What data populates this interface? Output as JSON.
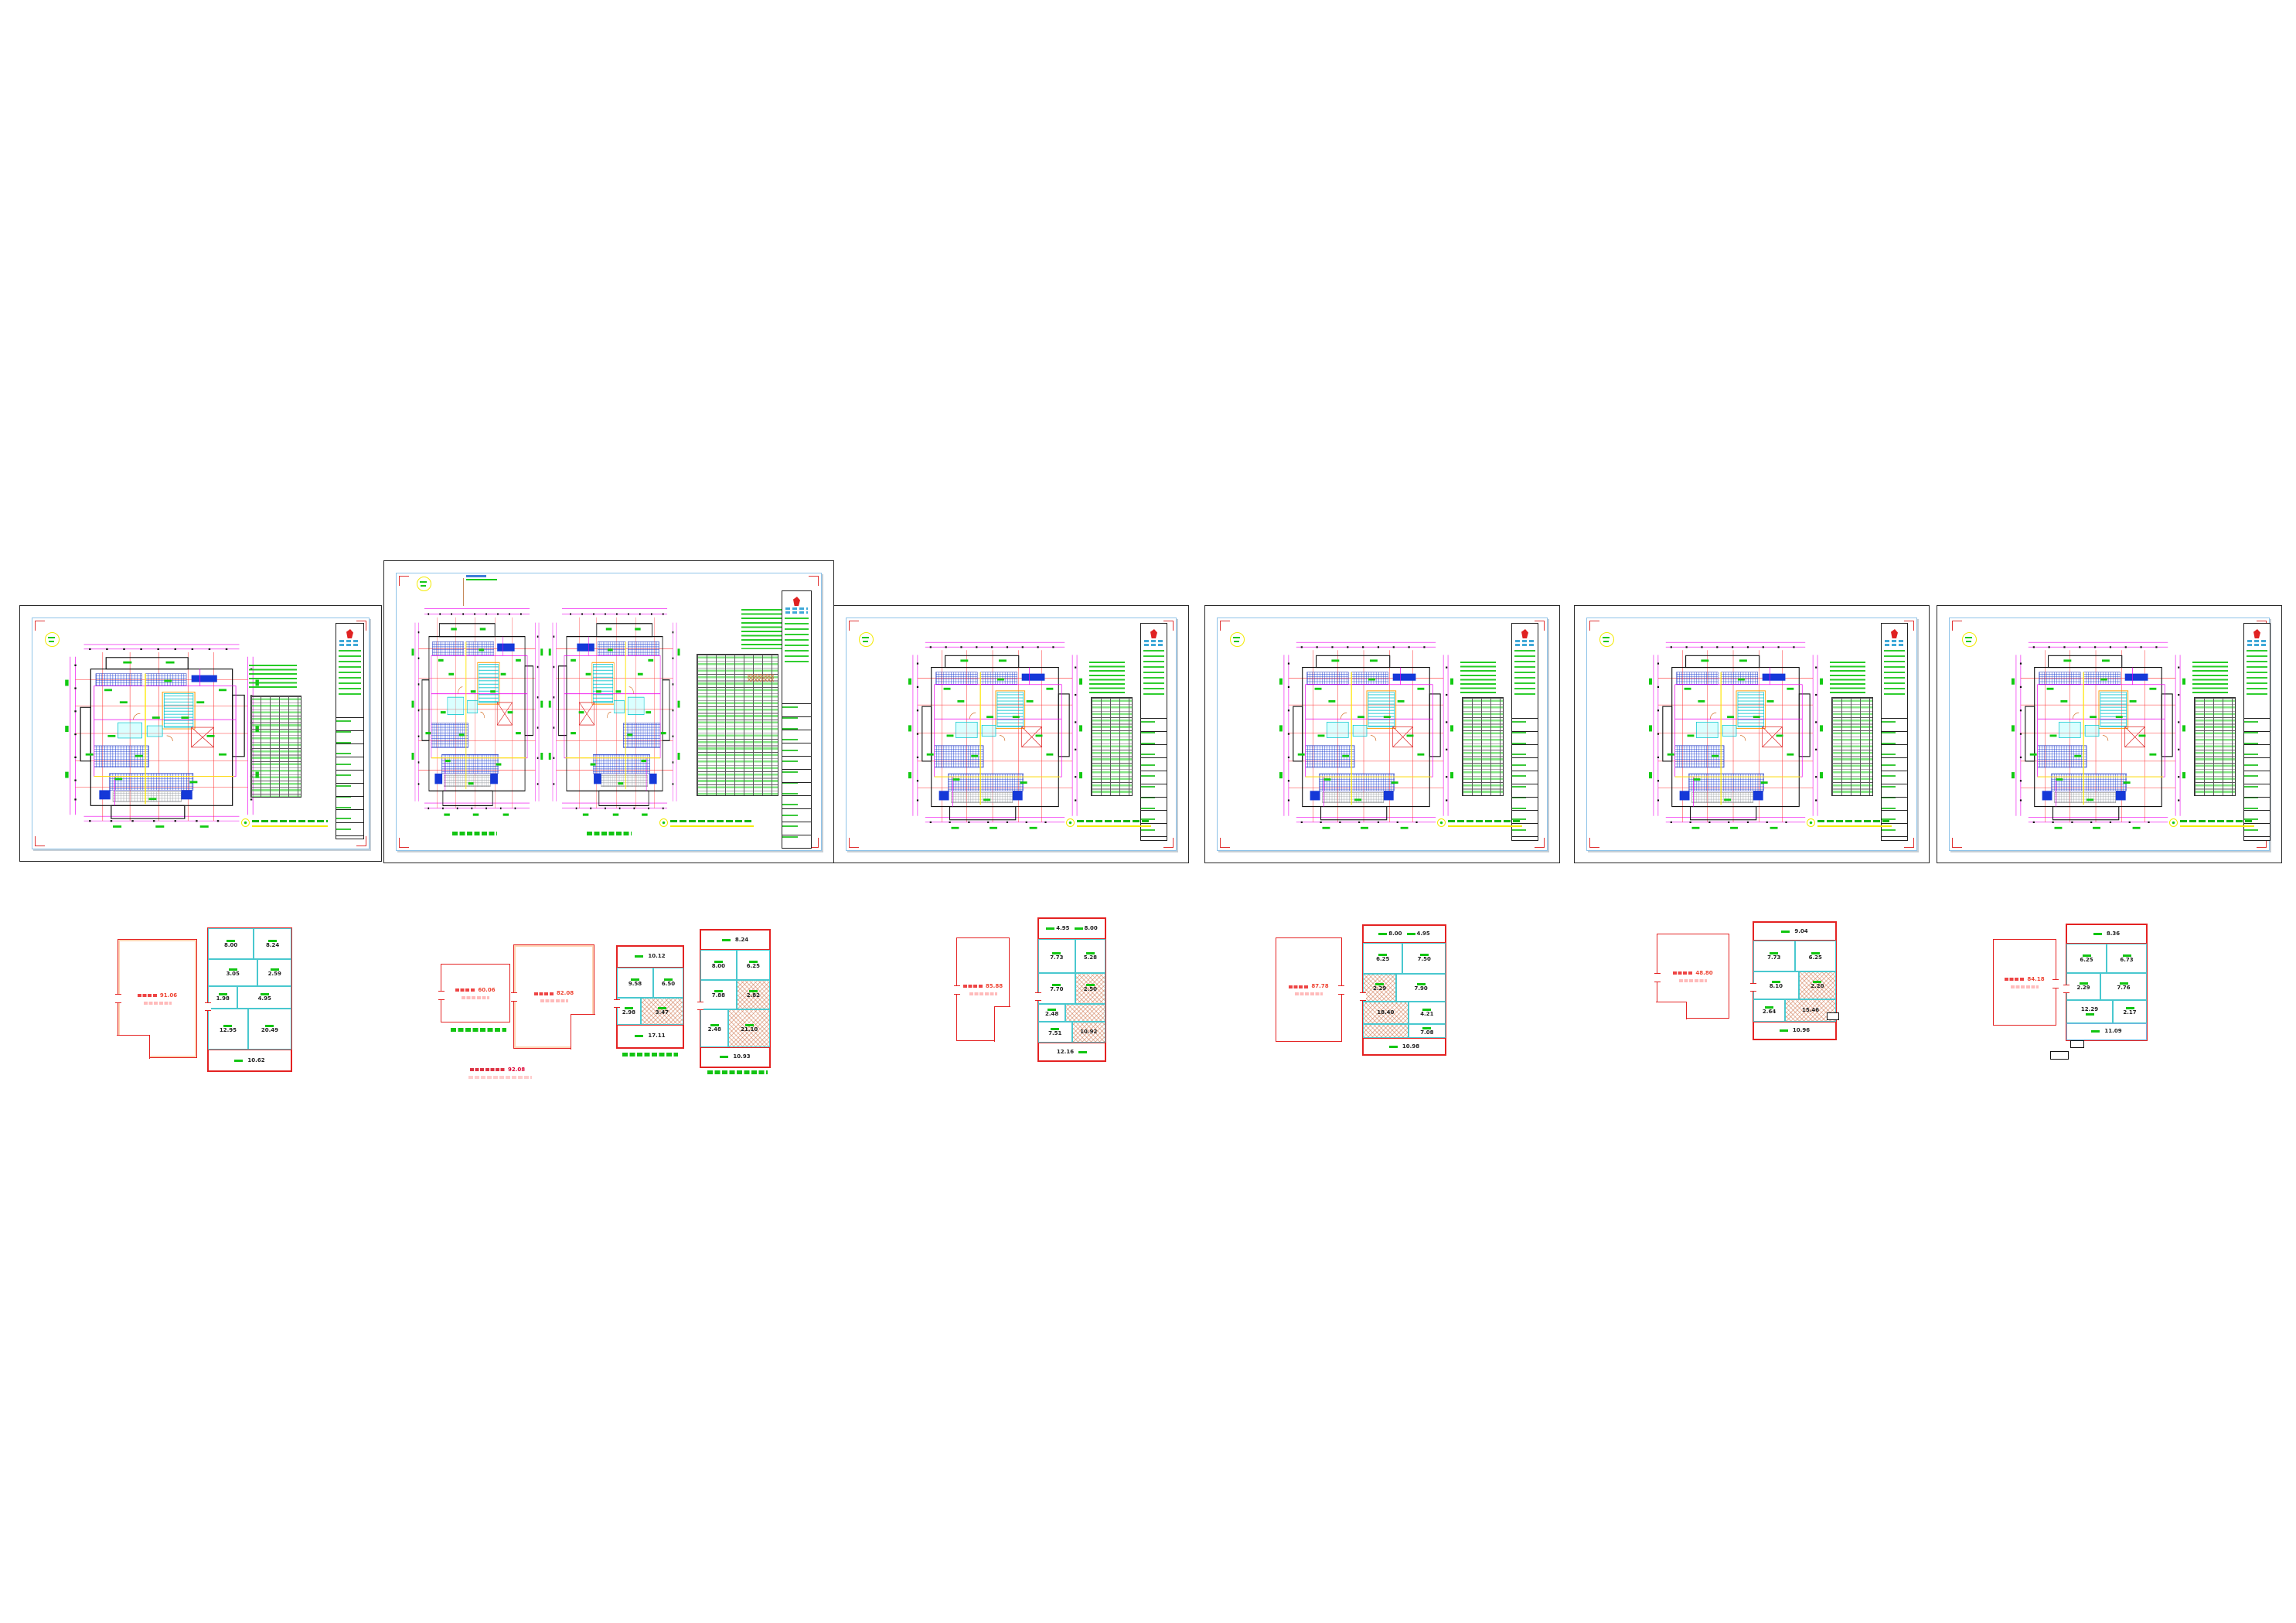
{
  "app": {
    "type": "CAD drawing canvas",
    "background": "#ffffff",
    "content": "six architectural plan sheets with unit area diagrams below"
  },
  "palette": {
    "sheet_border": "#2a2a2a",
    "inner_frame": "#8fc3e8",
    "corner_marks": "#e03333",
    "annotations_green": "#12c412",
    "dims_magenta": "#ee00ee",
    "axes_red": "#ff3333",
    "hatch_blue": "#2747d4",
    "stairs_cyan": "#00c4cc",
    "highlight_yellow": "#f3ea00",
    "unit_outline_red": "#e42222",
    "unit_partition_cyan": "#49c8cf"
  },
  "sheets": [
    {
      "id": "sheet-1",
      "plans": 1,
      "scale": "1:100"
    },
    {
      "id": "sheet-2",
      "plans": 2,
      "scale": "1:100"
    },
    {
      "id": "sheet-3",
      "plans": 1,
      "scale": "1:100"
    },
    {
      "id": "sheet-4",
      "plans": 1,
      "scale": "1:100"
    },
    {
      "id": "sheet-5",
      "plans": 1,
      "scale": "1:100"
    },
    {
      "id": "sheet-6",
      "plans": 1,
      "scale": "1:100"
    }
  ],
  "clusters": {
    "a": {
      "area": {
        "value": "91.06"
      },
      "unit": {
        "rooms": [
          "8.00",
          "8.24",
          "3.05",
          "2.59",
          "1.98",
          "4.95",
          "12.95",
          "20.49"
        ],
        "bottom": "10.62"
      }
    },
    "b": {
      "area1": {
        "value": "60.06"
      },
      "area2": {
        "value": "82.08"
      },
      "unit1": {
        "top": "10.12",
        "rooms": [
          "9.58",
          "6.50",
          "2.98",
          "3.47"
        ],
        "bottom": "17.11"
      },
      "unit2": {
        "top": "8.24",
        "rooms": [
          "8.00",
          "6.25",
          "7.88",
          "2.82",
          "2.48",
          "21.10"
        ],
        "bottom": "10.93"
      },
      "red_caption_value": "92.08"
    },
    "c": {
      "area": {
        "value": "85.88"
      },
      "unit": {
        "top1": "4.95",
        "top2": "8.00",
        "rooms": [
          "7.73",
          "5.28",
          "7.70",
          "2.50",
          "2.48",
          "7.51",
          "10.92"
        ],
        "bottom": "12.16"
      }
    },
    "d": {
      "area": {
        "value": "87.78"
      },
      "unit": {
        "top1": "8.00",
        "top2": "4.95",
        "rooms": [
          "6.25",
          "7.50",
          "2.29",
          "7.90",
          "18.40",
          "4.21",
          "7.08"
        ],
        "bottom": "10.98"
      }
    },
    "e": {
      "area": {
        "value": "48.80"
      },
      "unit": {
        "top": "9.04",
        "rooms": [
          "7.73",
          "6.25",
          "8.10",
          "2.20",
          "2.64",
          "15.46"
        ],
        "bottom": "10.96"
      }
    },
    "f": {
      "area": {
        "value": "84.18"
      },
      "unit": {
        "top": "8.36",
        "rooms": [
          "6.25",
          "6.73",
          "2.29",
          "7.76",
          "12.29",
          "2.17"
        ],
        "bottom": "11.09"
      }
    }
  }
}
